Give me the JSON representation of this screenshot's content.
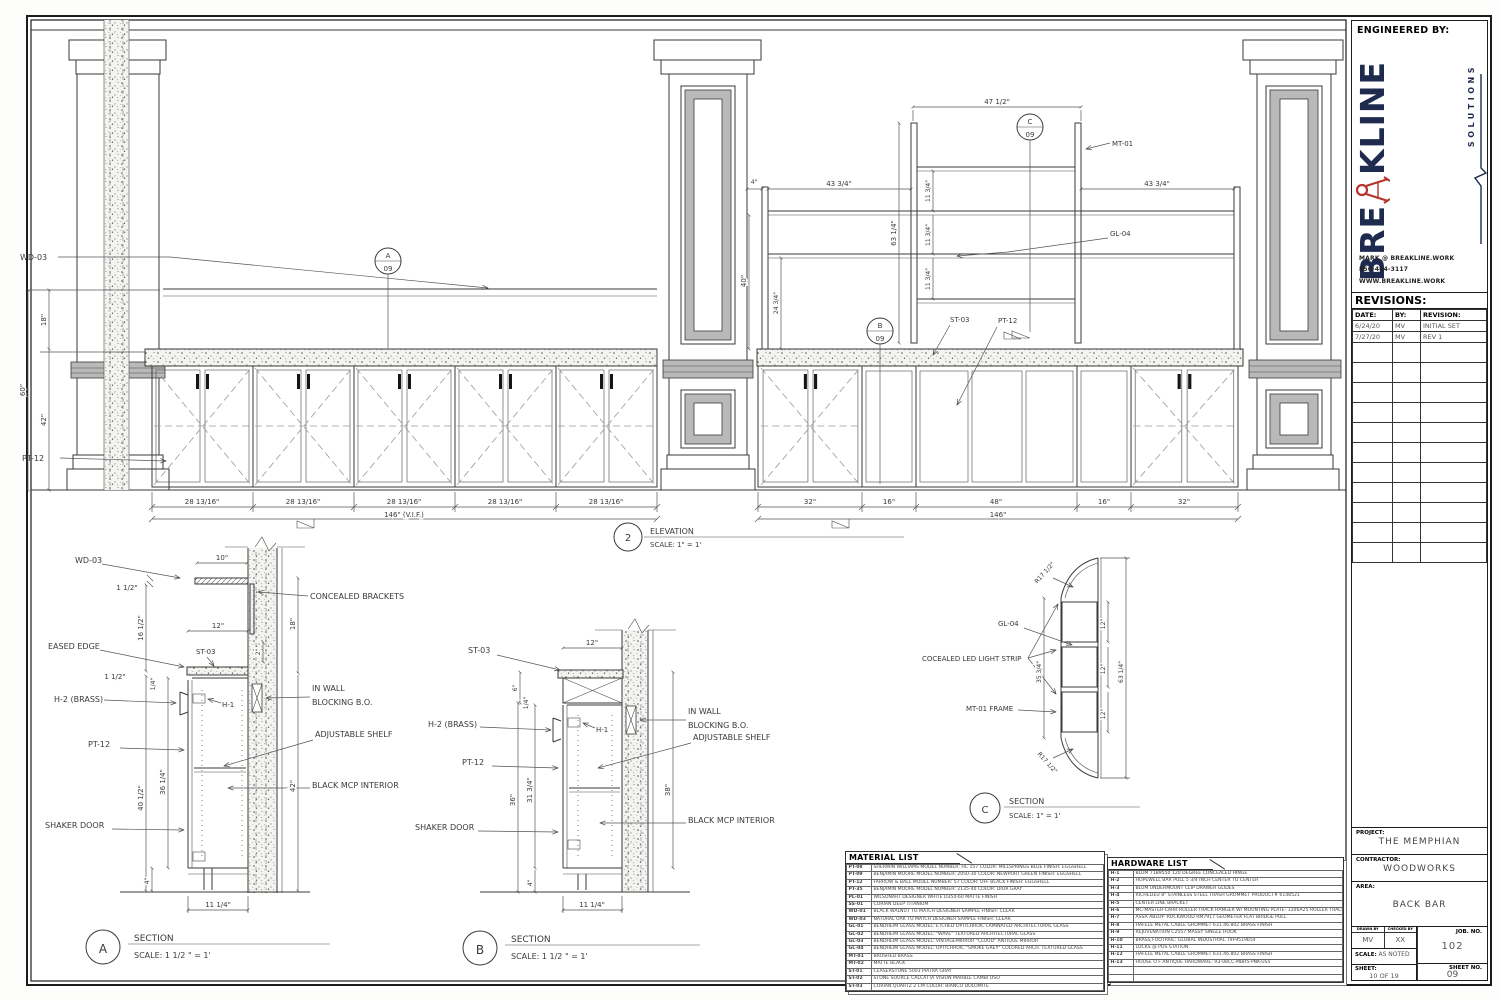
{
  "sheet": {
    "engineered_by": "ENGINEERED BY:",
    "logo": {
      "brand_left": "BRE",
      "brand_right": "KLINE",
      "sub": "SOLUTIONS",
      "contact_email": "MARK @ BREAKLINE.WORK",
      "contact_phone": "856-404-3117",
      "contact_web": "WWW.BREAKLINE.WORK",
      "brand_color": "#1e2b4f",
      "accent_color": "#b5342c"
    },
    "revisions": {
      "title": "REVISIONS:",
      "headers": [
        "DATE:",
        "BY:",
        "REVISION:"
      ],
      "rows": [
        [
          "6/24/20",
          "MV",
          "INITIAL SET"
        ],
        [
          "7/27/20",
          "MV",
          "REV 1"
        ],
        [
          "",
          "",
          ""
        ],
        [
          "",
          "",
          ""
        ],
        [
          "",
          "",
          ""
        ],
        [
          "",
          "",
          ""
        ],
        [
          "",
          "",
          ""
        ],
        [
          "",
          "",
          ""
        ],
        [
          "",
          "",
          ""
        ],
        [
          "",
          "",
          ""
        ],
        [
          "",
          "",
          ""
        ],
        [
          "",
          "",
          ""
        ],
        [
          "",
          "",
          ""
        ]
      ]
    },
    "project_label": "PROJECT:",
    "project": "THE MEMPHIAN",
    "contractor_label": "CONTRACTOR:",
    "contractor": "WOODWORKS",
    "area_label": "AREA:",
    "area": "BACK BAR",
    "drawn_by_label": "DRAWN BY",
    "drawn_by": "MV",
    "checked_by_label": "CHECKED BY",
    "checked_by": "XX",
    "scale_label": "SCALE:",
    "scale": "AS NOTED",
    "job_no_label": "JOB. NO.",
    "job_no": "102",
    "sheet_label": "SHEET:",
    "sheet_count": "10 OF 19",
    "sheet_no_label": "SHEET NO.",
    "sheet_no": "09"
  },
  "elevation": {
    "number": "2",
    "title": "ELEVATION",
    "scale": "SCALE: 1\" = 1'",
    "callout_a": "A",
    "callout_b": "B",
    "callout_c": "C",
    "callout_sheet": "09",
    "labels": {
      "wd03": "WD-03",
      "pt12_left": "PT-12",
      "mt01": "MT-01",
      "gl04": "GL-04",
      "st03": "ST-03",
      "pt12_right": "PT-12"
    },
    "dims": {
      "d18": "18\"",
      "d60": "60\"",
      "d42": "42\"",
      "d4": "4\"",
      "d43_34": "43 3/4\"",
      "d63_14": "63 1/4\"",
      "d11_34": "11 3/4\"",
      "d40": "40\"",
      "d24_34": "24 3/4\"",
      "d47_12": "47 1/2\"",
      "d28": "28 13/16\"",
      "d146vif": "146\" (V.I.F.)",
      "d32": "32\"",
      "d16": "16\"",
      "d48": "48\"",
      "d146": "146\""
    }
  },
  "sectionA": {
    "letter": "A",
    "title": "SECTION",
    "scale": "SCALE: 1 1/2 \" = 1'",
    "labels": {
      "wd03": "WD-03",
      "concealed": "CONCEALED BRACKETS",
      "eased": "EASED EDGE",
      "st03": "ST-03",
      "h2": "H-2 (BRASS)",
      "h1": "H-1",
      "inwall1": "IN WALL",
      "inwall2": "BLOCKING B.O.",
      "adj": "ADJUSTABLE SHELF",
      "pt12": "PT-12",
      "mcp": "BLACK MCP INTERIOR",
      "shaker": "SHAKER DOOR"
    },
    "dims": {
      "d10": "10\"",
      "d1_12": "1 1/2\"",
      "d16_12": "16 1/2\"",
      "d12": "12\"",
      "d2": "2\"",
      "d18": "18\"",
      "d14": "1/4\"",
      "d40_12": "40 1/2\"",
      "d36_14": "36 1/4\"",
      "d42": "42\"",
      "d4": "4\"",
      "d11_14": "11 1/4\""
    }
  },
  "sectionB": {
    "letter": "B",
    "title": "SECTION",
    "scale": "SCALE: 1 1/2 \" = 1'",
    "labels": {
      "st03": "ST-03",
      "h2": "H-2 (BRASS)",
      "h1": "H-1",
      "inwall1": "IN WALL",
      "inwall2": "BLOCKING B.O.",
      "adj": "ADJUSTABLE SHELF",
      "pt12": "PT-12",
      "mcp": "BLACK MCP INTERIOR",
      "shaker": "SHAKER DOOR"
    },
    "dims": {
      "d12": "12\"",
      "d6": "6\"",
      "d14": "1/4\"",
      "d36": "36\"",
      "d31_34": "31 3/4\"",
      "d38": "38\"",
      "d4": "4\"",
      "d11_14": "11 1/4\""
    }
  },
  "sectionC": {
    "letter": "C",
    "title": "SECTION",
    "scale": "SCALE: 1\" = 1'",
    "labels": {
      "gl04": "GL-04",
      "led": "COCEALED LED LIGHT STRIP",
      "mt01": "MT-01 FRAME",
      "r17": "R17 1/2\""
    },
    "dims": {
      "d35_34": "35 3/4\"",
      "d12": "12\"",
      "d63_14": "63 1/4\""
    }
  },
  "material_list": {
    "title": "MATERIAL LIST",
    "rows": [
      [
        "PT-08",
        "SHERWIN WILLIAMS MODEL NUMBER: HC 157 COLOR: MILLSPRINGS BLUE FINISH: EGGSHELL"
      ],
      [
        "PT-09",
        "BENJAMIN MOORE MODEL NUMBER: 2050-30 COLOR: NEWPORT GREEN FINISH: EGGSHELL"
      ],
      [
        "PT-12",
        "FARROW & BALL MODEL NUMBER: 57 COLOR: OFF BLACK FINISH: EGGSHELL"
      ],
      [
        "PT-35",
        "BENJAMIN MOORE MODEL NUMBER: 2135-40 COLOR: DIOR GRAY"
      ],
      [
        "PL-01",
        "WILSONART DESIGNER WHITE D354-60 MATTE FINISH"
      ],
      [
        "SS-01",
        "CORIAN DEEP TITANIUM"
      ],
      [
        "WD-01",
        "BLACK WALNUT TO MATCH DESIGNER SAMPLE FINISH: CLEAR"
      ],
      [
        "WD-03",
        "NATURAL OAK TO MATCH DESIGNER SAMPLE FINISH: CLEAR"
      ],
      [
        "GL-01",
        "BENDHEIM GLASS MODEL: ETCHED OPTICHROIC LAMINATED ARCHITECTURAL GLASS"
      ],
      [
        "GL-02",
        "BENDHEIM GLASS MODEL: \"WAVE\" TEXTURED ARCHITECTURAL GLASS"
      ],
      [
        "GL-03",
        "BENDHEIM GLASS MODEL: VINTAGEMIRROR \"CLOUD\" ANTIQUE MIRROR"
      ],
      [
        "GL-04",
        "BENDHEIM GLASS MODEL: OPTICHROIC \"SMOKE GREY\" COLORED ARCH. TEXTURED GLASS"
      ],
      [
        "MT-01",
        "BRUSHED BRASS"
      ],
      [
        "MT-02",
        "MATTE BLACK"
      ],
      [
        "ST-01",
        "CEASERSTONE 5003 PIATRA GRAY"
      ],
      [
        "ST-02",
        "STONE SOURCE CALCATTA VISION MARBLE CAMBI OSO"
      ],
      [
        "ST-03",
        "CORIAN QUARTZ 2 CM COLOR: BIANCO DOLOMITE"
      ]
    ]
  },
  "hardware_list": {
    "title": "HARDWARE LIST",
    "rows": [
      [
        "H-1",
        "BLUM 71B9550 120 DEGREE CONCEALED HINGE"
      ],
      [
        "H-2",
        "HOPEWELL BAR PULL 5 3/4 INCH CENTER TO CENTER"
      ],
      [
        "H-3",
        "BLUM UNDERMOUNT CLIP DRAWER GLIDES"
      ],
      [
        "H-4",
        "RICHELIEU 8\" STAINLESS STEEL TRASH GROMMET PRODUCT# 6148521"
      ],
      [
        "H-5",
        "CENTER LINE BRACKET"
      ],
      [
        "H-6",
        "MC-MASTER-CARR ROLLER TRACK HANGER W/ MOUNTING PLATE- 1206A25 ROLLER TRACK- 1207A26"
      ],
      [
        "H-7",
        "ASSA ABLOY- ROCKWOOD RM7917 GEOMETEK FLAT BRIDGE PULL"
      ],
      [
        "H-8",
        "HAFELE METAL CABLE GROMMET 631.46.802 BRASS FINISH"
      ],
      [
        "H-9",
        "REJUVENATION C2557 MASSY SINGLE HOOK"
      ],
      [
        "H-10",
        "BRASS FOOTRAIL: GLOBAL INDUSTRIAL T9F9519654"
      ],
      [
        "H-11",
        "LOCKS @ POS STATION"
      ],
      [
        "H-12",
        "HAFELE METAL CABLE GROMMET 631.46.802 BRASS FINISH"
      ],
      [
        "H-13",
        "HOUSE O F ANTIQUE HARDWARE: R3-08CC-MBR5-PNK-US5"
      ],
      [
        "",
        ""
      ],
      [
        "",
        ""
      ]
    ]
  }
}
